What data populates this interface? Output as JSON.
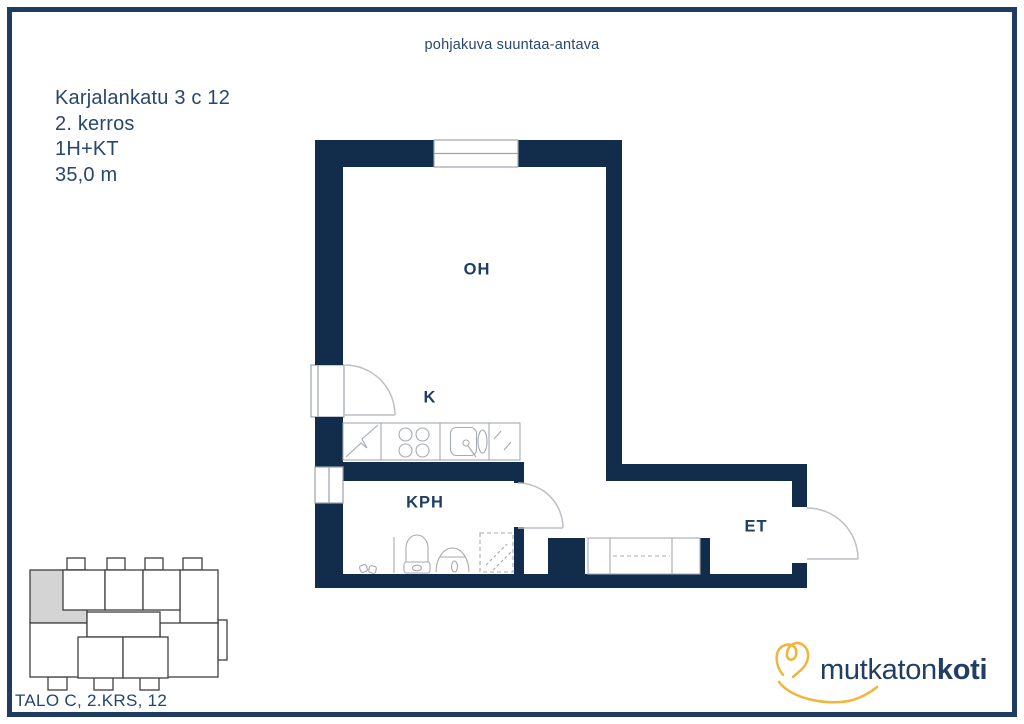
{
  "note": "pohjakuva suuntaa-antava",
  "header": {
    "address": "Karjalankatu 3 c 12",
    "floor": "2. kerros",
    "layout": "1H+KT",
    "area": "35,0 m"
  },
  "rooms": {
    "oh": {
      "label": "OH"
    },
    "k": {
      "label": "K"
    },
    "kph": {
      "label": "KPH"
    },
    "et": {
      "label": "ET"
    }
  },
  "minimap": {
    "caption": "TALO C, 2.KRS, 12"
  },
  "logo": {
    "regular": "mutkaton",
    "bold": "koti"
  },
  "icons": {
    "heart-doodle-icon": "hand-drawn heart with smile swoosh (svg)",
    "window": "svg",
    "door-swing": "svg",
    "stove-hob": "svg",
    "fridge": "svg",
    "kitchen-sink": "svg",
    "toilet": "svg",
    "washbasin": "svg",
    "floor-drain": "svg",
    "washer-reservation": "svg",
    "wardrobe": "svg"
  },
  "colors": {
    "wall_navy": "#122c4c",
    "border_navy": "#1e3c61",
    "text_navy": "#27476f",
    "label_navy": "#1d3e66",
    "logo_navy": "#213e63",
    "accent_yellow": "#f2b539",
    "highlight_gray": "#d4d4d4"
  }
}
